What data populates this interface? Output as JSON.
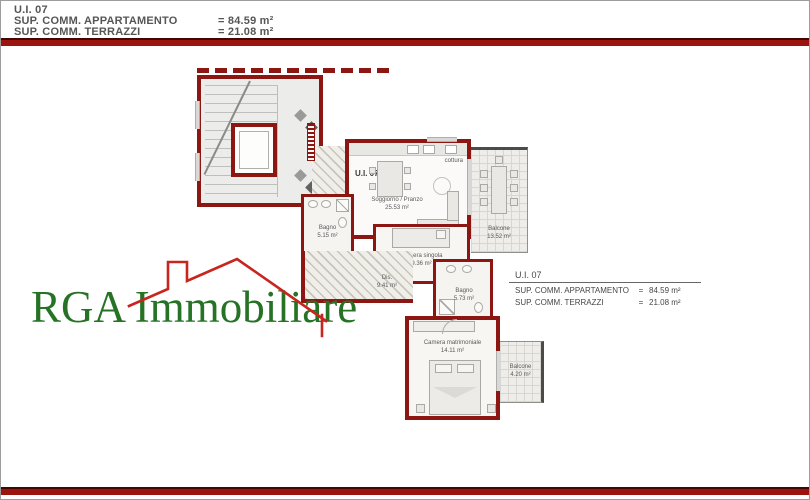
{
  "header": {
    "unit": "U.I. 07",
    "apartment_label": "SUP. COMM. APPARTAMENTO",
    "apartment_value": "= 84.59 m²",
    "terraces_label": "SUP. COMM. TERRAZZI",
    "terraces_value": "= 21.08 m²"
  },
  "info_box": {
    "unit": "U.I. 07",
    "apartment_label": "SUP. COMM. APPARTAMENTO",
    "apartment_eq": "=",
    "apartment_value": "84.59 m²",
    "terraces_label": "SUP. COMM. TERRAZZI",
    "terraces_eq": "=",
    "terraces_value": "21.08 m²"
  },
  "floorplan": {
    "unit_label": "U.I. 07",
    "kitchen_label": "cottura",
    "rooms": {
      "soggiorno": {
        "name": "Soggiorno / Pranzo",
        "area": "25.53 m²"
      },
      "bagno1": {
        "name": "Bagno",
        "area": "5.15 m²"
      },
      "camera_singola": {
        "name": "Camera singola",
        "area": "9.36 m²"
      },
      "dis": {
        "name": "Dis.",
        "area": "9.41 m²"
      },
      "bagno2": {
        "name": "Bagno",
        "area": "5.73 m²"
      },
      "camera_matrimoniale": {
        "name": "Camera matrimoniale",
        "area": "14.11 m²"
      },
      "balcone_grande": {
        "name": "Balcone",
        "area": "13.52 m²"
      },
      "balcone_piccolo": {
        "name": "Balcone",
        "area": "4.20 m²"
      }
    }
  },
  "logo": {
    "text": "RGA Immobiliare"
  },
  "colors": {
    "wall": "#8c1712",
    "bar": "#9b140d",
    "logo_green": "#267326",
    "logo_red": "#c7251d"
  }
}
